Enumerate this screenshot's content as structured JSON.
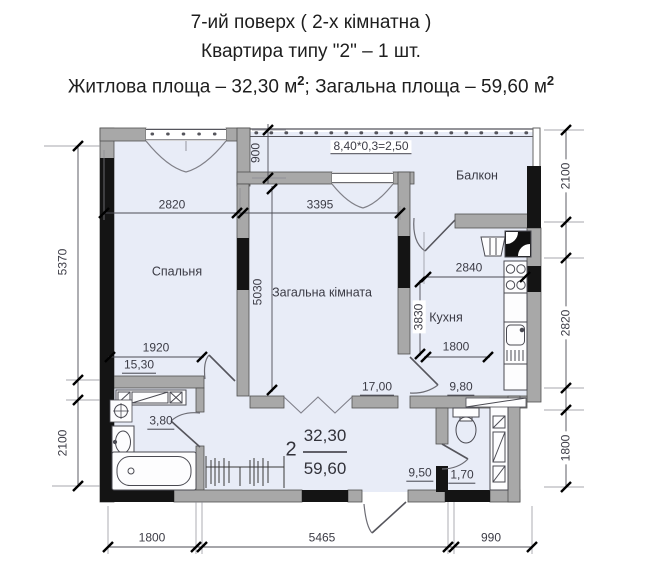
{
  "title": {
    "line1": "7-ий поверх ( 2-х кімнатна )",
    "line2": "Квартира типу \"2\" – 1 шт.",
    "area_line": {
      "part1": "Житлова площа – 32,30 м",
      "sup1": "2",
      "part2": "; Загальна площа – 59,60 м",
      "sup2": "2"
    }
  },
  "plan": {
    "rooms": {
      "bedroom": {
        "name": "Спальня",
        "area": "15,30"
      },
      "living": {
        "name": "Загальна кімната",
        "area": "17,00"
      },
      "kitchen": {
        "name": "Кухня",
        "area": "9,80"
      },
      "balcony": {
        "name": "Балкон",
        "area_formula": "8,40*0,3=2,50"
      },
      "hallway": {
        "area": "9,50"
      },
      "bathroom": {
        "area": "3,80"
      },
      "wc": {
        "area": "1,70"
      }
    },
    "summary": {
      "apartment_number": "2",
      "living_area": "32,30",
      "total_area": "59,60"
    },
    "dims": {
      "top_bedroom": "2820",
      "top_living": "3395",
      "balcony_depth": "900",
      "left_upper": "5370",
      "left_lower": "2100",
      "right_balcony": "2100",
      "right_kitchen": "2820",
      "right_lower": "1800",
      "bottom_left": "1800",
      "bottom_middle": "5465",
      "bottom_right": "990",
      "living_height": "5030",
      "bedroom_width": "1920",
      "kitchen_width": "2840",
      "kitchen_height": "3830",
      "kitchen_inner": "1800"
    }
  }
}
